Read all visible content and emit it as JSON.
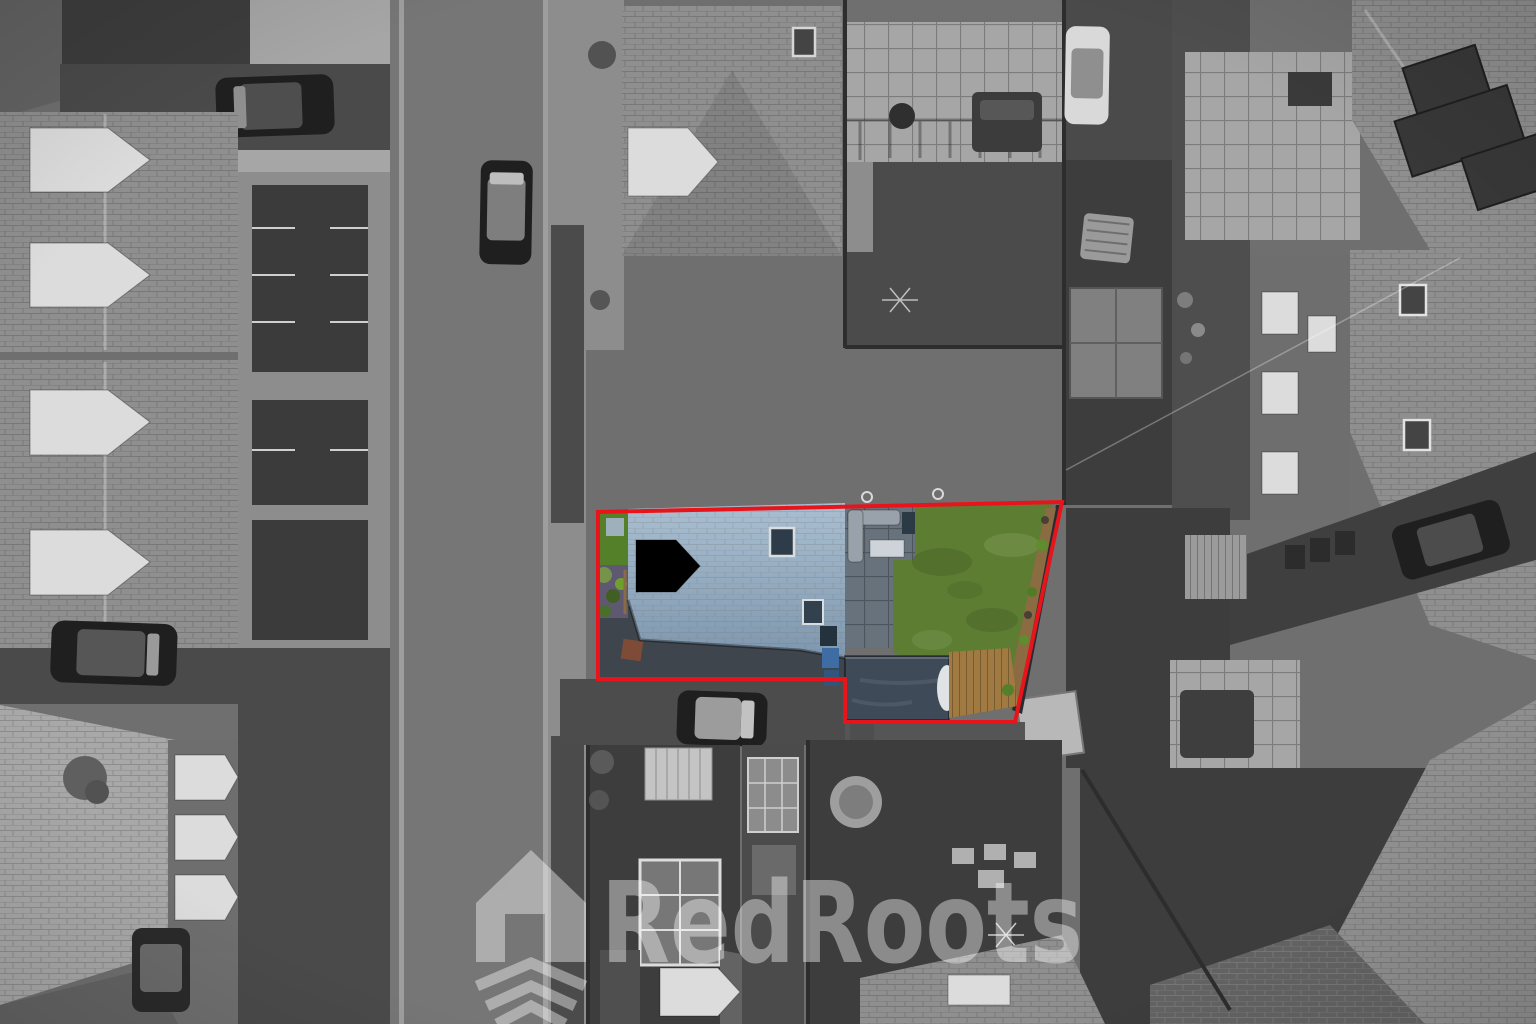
{
  "image": {
    "type": "aerial-drone-photograph",
    "treatment": "selective-colour (scene in greyscale, subject property in colour)",
    "subject": "residential street, top-down view, property plot outlined in red"
  },
  "watermark": {
    "text": "RedRoots",
    "icon": "house-roots-icon",
    "color": "#ffffff",
    "opacity": "0.4"
  },
  "boundary": {
    "color": "#e8141b",
    "stroke_width": "4"
  },
  "palette": {
    "ground": "#6f6f6f",
    "road": "#767676",
    "roadEdge": "#9e9e9e",
    "paveLight": "#a6a6a6",
    "paveMid": "#8d8d8d",
    "driveDark": "#4a4a4a",
    "court": "#3b3b3b",
    "roofLight": "#a8a8a8",
    "roofMid": "#8f8f8f",
    "roofDark": "#636363",
    "roofDarkest": "#4f4f4f",
    "facade": "#6e6e6e",
    "grassDark": "#4b4b4b",
    "grassDarker": "#3d3d3d",
    "fence": "#2d2d2d",
    "whiteDetail": "#dcdcdc",
    "carDark": "#1f1f1f",
    "carGray": "#9c9c9c",
    "solar": "#383838",
    "markLine": "#cfcfcf",
    "boundaryRed": "#e8141b",
    "watermark": "#ffffff",
    "roofBlueTop": "#aabfd1",
    "roofBlueBottom": "#7e97ae",
    "dormerCream": "#eae8df",
    "hedgeGreen": "#55802a",
    "gravelPurple": "#5e5870",
    "lawnGreen": "#5d7d33",
    "lawnDark": "#4a6628",
    "lawnLight": "#76934b",
    "patioBlue": "#67727c",
    "sofaGray": "#99a2aa",
    "tableWhite": "#cdd3d8",
    "gardenRoom": "#3e4a57",
    "deckWood": "#a17a41",
    "planterWood": "#8a6b42",
    "fenceBlue": "#272c32",
    "binBlue": "#3d6da3",
    "slabBrown": "#7d4b36",
    "driveTint": "#3f454d",
    "slabBlue": "#9fb0bd"
  }
}
